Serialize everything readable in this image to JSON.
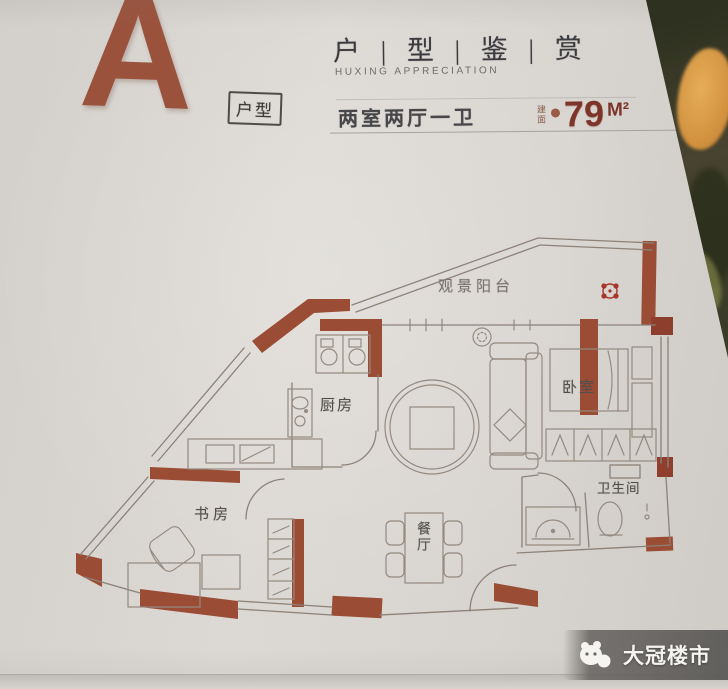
{
  "header": {
    "plan_letter": "A",
    "plan_tag": "户型",
    "title": "户 | 型 | 鉴 | 赏",
    "subtitle": "HUXING APPRECIATION",
    "spec": "两室两厅一卫",
    "area_prefix": "建面",
    "area_value": "79",
    "area_unit": "M²"
  },
  "floorplan": {
    "rooms": {
      "balcony": "观景阳台",
      "kitchen": "厨房",
      "bedroom": "卧室",
      "study": "书房",
      "dining": "餐厅",
      "bathroom": "卫生间"
    },
    "icons": {
      "stamp": "flower-stamp",
      "furniture": [
        "stove",
        "sink",
        "sofa",
        "rug",
        "coffee-table",
        "plant",
        "bed",
        "wardrobe",
        "dining-table",
        "desk",
        "office-chair",
        "toilet",
        "wash-basin"
      ]
    }
  },
  "watermark": {
    "brand": "大冠楼市",
    "logo": "panda-mascot"
  },
  "colors": {
    "paper": "#d9d5d0",
    "wall_accent": "#9a4c35",
    "plan_line": "#8c8278",
    "letter_accent": "#9b523d",
    "area_text": "#7d352a",
    "stamp_red": "#a8352a",
    "background_dark": "#3a3b28",
    "background_orange": "#cf8f3d"
  }
}
